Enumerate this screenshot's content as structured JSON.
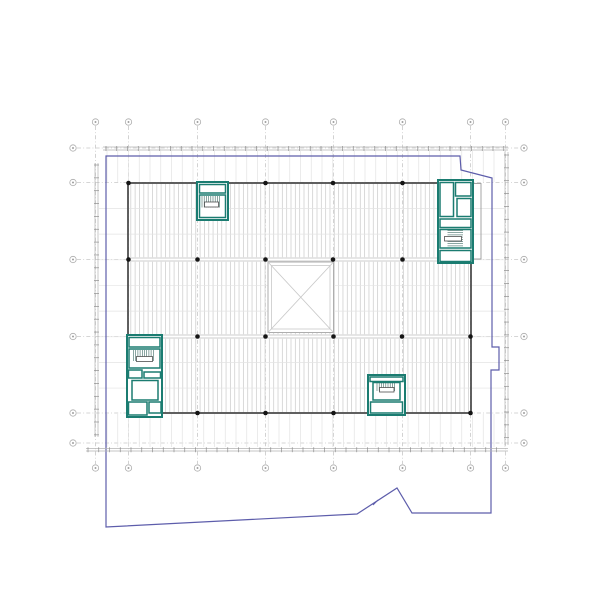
{
  "meta": {
    "canvas": {
      "w": 600,
      "h": 600,
      "bg": "#ffffff"
    },
    "drawing_kind": "architectural-floor-plan"
  },
  "palette": {
    "grid": "#c8c8c8",
    "hatch": "#d0d0d0",
    "faint": "#e3e3e3",
    "beam": "#bdbdbd",
    "dim": "#b3b3b3",
    "tick": "#8f8f8f",
    "outline": "#4f4f4f",
    "wallLight": "#9b9b9b",
    "teal": "#1b7c71",
    "tread": "#3d6a63",
    "blue": "#5d5dab",
    "black": "#151515",
    "shaft": "#aeaeae",
    "shaftX": "#c9c9c9",
    "bubble": "#adadad",
    "white": "#ffffff",
    "none": "none"
  },
  "grid": {
    "cols": [
      95.5,
      128.5,
      197.5,
      265.5,
      333.5,
      402.5,
      470.5,
      505.5
    ],
    "rows": [
      148,
      182.5,
      259.5,
      336.5,
      413,
      443
    ]
  },
  "layers": [
    {
      "t": "gridv",
      "n": "grid-line-vertical",
      "xs": [
        95.5,
        128.5,
        197.5,
        265.5,
        333.5,
        402.5,
        470.5,
        505.5
      ],
      "y0": 126,
      "y1": 464,
      "c": "grid",
      "w": 0.8,
      "dash": "4 2.2 0.9 2.2"
    },
    {
      "t": "gridh",
      "n": "grid-line-horizontal",
      "ys": [
        148,
        182.5,
        259.5,
        336.5,
        413,
        443
      ],
      "x0": 77,
      "x1": 520,
      "c": "grid",
      "w": 0.8,
      "dash": "4 2.2 0.9 2.2"
    },
    {
      "t": "vlines",
      "n": "extension-line-top",
      "x0": 107,
      "x1": 505,
      "step": 10.75,
      "y0": 151,
      "y1": 182,
      "c": "faint",
      "w": 0.7
    },
    {
      "t": "vlines",
      "n": "extension-line-bottom",
      "x0": 107,
      "x1": 505,
      "step": 10.75,
      "y0": 414,
      "y1": 447,
      "c": "faint",
      "w": 0.7
    },
    {
      "t": "hlines",
      "n": "extension-line-left",
      "y0": 208.5,
      "y1": 389,
      "step": 25.65,
      "x0": 99,
      "x1": 127.5,
      "c": "faint",
      "w": 0.7
    },
    {
      "t": "hlines",
      "n": "extension-line-right",
      "y0": 208.5,
      "y1": 389,
      "step": 25.65,
      "x0": 471.5,
      "x1": 504,
      "c": "faint",
      "w": 0.7
    },
    {
      "t": "vlines",
      "n": "deck-hatch",
      "x0": 130.8,
      "x1": 469.2,
      "step": 4.33,
      "y0": 183.6,
      "y1": 412.4,
      "c": "hatch",
      "w": 0.8
    },
    {
      "t": "hlines",
      "n": "secondary-beam-line",
      "y0": 208.5,
      "y1": 389,
      "step": 25.65,
      "x0": 129,
      "x1": 470,
      "c": "faint",
      "w": 0.7
    },
    {
      "t": "rect",
      "n": "beam-band",
      "x": 129,
      "y": 257.2,
      "w": 341,
      "h": 4.6,
      "f": "white",
      "s": "none",
      "sw": 0
    },
    {
      "t": "lines",
      "n": "beam-line",
      "segs": [
        [
          128,
          258,
          471,
          258
        ],
        [
          128,
          261,
          471,
          261
        ]
      ],
      "c": "beam",
      "w": 0.8
    },
    {
      "t": "rect",
      "n": "beam-band",
      "x": 129,
      "y": 334.2,
      "w": 341,
      "h": 4.6,
      "f": "white",
      "s": "none",
      "sw": 0
    },
    {
      "t": "lines",
      "n": "beam-line",
      "segs": [
        [
          128,
          335,
          471,
          335
        ],
        [
          128,
          338,
          471,
          338
        ]
      ],
      "c": "beam",
      "w": 0.8
    },
    {
      "t": "rect",
      "n": "atrium-shaft",
      "x": 268,
      "y": 262,
      "w": 65.5,
      "h": 70.5,
      "f": "white",
      "s": "shaft",
      "sw": 1
    },
    {
      "t": "rect",
      "n": "atrium-shaft-inner",
      "x": 271.5,
      "y": 265.5,
      "w": 58.5,
      "h": 63.5,
      "f": "none",
      "s": "shaftX",
      "sw": 0.8
    },
    {
      "t": "lines",
      "n": "atrium-x-brace",
      "segs": [
        [
          268,
          262,
          333.5,
          332.5
        ],
        [
          333.5,
          262,
          268,
          332.5
        ]
      ],
      "c": "shaftX",
      "w": 0.9
    },
    {
      "t": "rect",
      "n": "building-outline",
      "x": 128,
      "y": 183,
      "w": 343,
      "h": 230,
      "f": "none",
      "s": "outline",
      "sw": 1.8
    },
    {
      "t": "rect",
      "n": "building-annex-outline",
      "x": 471,
      "y": 183.5,
      "w": 10,
      "h": 75.5,
      "f": "none",
      "s": "wallLight",
      "sw": 0.9
    },
    {
      "t": "rect",
      "n": "stair-core-top-left",
      "x": 197,
      "y": 182,
      "w": 31,
      "h": 38,
      "f": "white",
      "s": "teal",
      "sw": 2
    },
    {
      "t": "rect",
      "n": "core-room",
      "x": 199.5,
      "y": 184.5,
      "w": 26,
      "h": 8.5,
      "f": "none",
      "s": "teal",
      "sw": 1.5
    },
    {
      "t": "rect",
      "n": "core-room",
      "x": 199.5,
      "y": 195,
      "w": 26,
      "h": 22.5,
      "f": "none",
      "s": "teal",
      "sw": 1.5
    },
    {
      "t": "vlines",
      "n": "stair-treads",
      "x0": 202,
      "x1": 221,
      "step": 2.2,
      "y0": 196,
      "y1": 207.5,
      "c": "tread",
      "w": 0.6
    },
    {
      "t": "rect",
      "n": "stair-landing",
      "x": 204.5,
      "y": 202,
      "w": 14,
      "h": 5,
      "f": "white",
      "s": "outline",
      "sw": 0.8
    },
    {
      "t": "rect",
      "n": "stair-core-top-right",
      "x": 438,
      "y": 180,
      "w": 35,
      "h": 83,
      "f": "white",
      "s": "teal",
      "sw": 2
    },
    {
      "t": "rect",
      "n": "core-room",
      "x": 440,
      "y": 182.5,
      "w": 13.5,
      "h": 34,
      "f": "none",
      "s": "teal",
      "sw": 1.5
    },
    {
      "t": "rect",
      "n": "core-room",
      "x": 455.5,
      "y": 182.5,
      "w": 15.5,
      "h": 13.5,
      "f": "none",
      "s": "teal",
      "sw": 1.5
    },
    {
      "t": "rect",
      "n": "core-room",
      "x": 457,
      "y": 198.5,
      "w": 14,
      "h": 18,
      "f": "none",
      "s": "teal",
      "sw": 1.5
    },
    {
      "t": "rect",
      "n": "core-room",
      "x": 440,
      "y": 219,
      "w": 31,
      "h": 8.5,
      "f": "none",
      "s": "teal",
      "sw": 1.5
    },
    {
      "t": "rect",
      "n": "core-room",
      "x": 440,
      "y": 229.5,
      "w": 31,
      "h": 18.5,
      "f": "none",
      "s": "teal",
      "sw": 1.5
    },
    {
      "t": "rect",
      "n": "core-room",
      "x": 440,
      "y": 250.5,
      "w": 31,
      "h": 11,
      "f": "none",
      "s": "teal",
      "sw": 1.5
    },
    {
      "t": "hlines",
      "n": "stair-treads",
      "y0": 230.5,
      "y1": 247,
      "step": 2.2,
      "x0": 447.5,
      "x1": 463,
      "c": "tread",
      "w": 0.6
    },
    {
      "t": "rect",
      "n": "stair-landing",
      "x": 444.5,
      "y": 236.5,
      "w": 17,
      "h": 4.5,
      "f": "white",
      "s": "outline",
      "sw": 0.8
    },
    {
      "t": "rect",
      "n": "stair-core-bottom-left",
      "x": 127,
      "y": 335,
      "w": 35,
      "h": 82,
      "f": "white",
      "s": "teal",
      "sw": 2
    },
    {
      "t": "rect",
      "n": "core-room",
      "x": 129,
      "y": 337.5,
      "w": 31,
      "h": 9.5,
      "f": "none",
      "s": "teal",
      "sw": 1.5
    },
    {
      "t": "rect",
      "n": "core-room",
      "x": 129,
      "y": 349,
      "w": 31,
      "h": 19,
      "f": "none",
      "s": "teal",
      "sw": 1.5
    },
    {
      "t": "rect",
      "n": "core-room",
      "x": 128.5,
      "y": 370,
      "w": 13.5,
      "h": 8,
      "f": "none",
      "s": "teal",
      "sw": 1.5
    },
    {
      "t": "rect",
      "n": "core-room",
      "x": 144,
      "y": 372,
      "w": 16.5,
      "h": 6,
      "f": "none",
      "s": "teal",
      "sw": 1.5
    },
    {
      "t": "rect",
      "n": "core-room",
      "x": 132,
      "y": 380.5,
      "w": 26,
      "h": 19.5,
      "f": "none",
      "s": "teal",
      "sw": 1.5
    },
    {
      "t": "rect",
      "n": "core-room",
      "x": 128.5,
      "y": 402,
      "w": 18.5,
      "h": 13,
      "f": "none",
      "s": "teal",
      "sw": 1.5
    },
    {
      "t": "rect",
      "n": "core-room",
      "x": 149,
      "y": 402,
      "w": 12,
      "h": 11,
      "f": "none",
      "s": "teal",
      "sw": 1.5
    },
    {
      "t": "vlines",
      "n": "stair-treads",
      "x0": 133.5,
      "x1": 155,
      "step": 2.2,
      "y0": 350,
      "y1": 361,
      "c": "tread",
      "w": 0.6
    },
    {
      "t": "rect",
      "n": "stair-landing",
      "x": 136.5,
      "y": 356.5,
      "w": 16,
      "h": 5,
      "f": "white",
      "s": "outline",
      "sw": 0.8
    },
    {
      "t": "rect",
      "n": "stair-core-bottom-right",
      "x": 368,
      "y": 375,
      "w": 37,
      "h": 40,
      "f": "white",
      "s": "teal",
      "sw": 2
    },
    {
      "t": "rect",
      "n": "core-room",
      "x": 370,
      "y": 377,
      "w": 33,
      "h": 4.5,
      "f": "none",
      "s": "teal",
      "sw": 1.5
    },
    {
      "t": "rect",
      "n": "core-room",
      "x": 373,
      "y": 382.5,
      "w": 27,
      "h": 17.5,
      "f": "none",
      "s": "teal",
      "sw": 1.5
    },
    {
      "t": "rect",
      "n": "core-room",
      "x": 370.5,
      "y": 402,
      "w": 32,
      "h": 11,
      "f": "none",
      "s": "teal",
      "sw": 1.5
    },
    {
      "t": "vlines",
      "n": "stair-treads",
      "x0": 377,
      "x1": 396,
      "step": 2.2,
      "y0": 383,
      "y1": 391,
      "c": "tread",
      "w": 0.6
    },
    {
      "t": "rect",
      "n": "stair-landing",
      "x": 379.5,
      "y": 387.5,
      "w": 14.5,
      "h": 4.5,
      "f": "white",
      "s": "outline",
      "sw": 0.8
    },
    {
      "t": "dots",
      "n": "column-dot",
      "r": 2.3,
      "c": "black",
      "pts": [
        [
          128.5,
          183
        ],
        [
          265.5,
          183
        ],
        [
          333,
          183
        ],
        [
          402.5,
          183
        ],
        [
          128.5,
          259.5
        ],
        [
          197.5,
          259.5
        ],
        [
          265.5,
          259.5
        ],
        [
          333,
          259.5
        ],
        [
          402.5,
          259.5
        ],
        [
          197.5,
          336.5
        ],
        [
          265.5,
          336.5
        ],
        [
          333.5,
          336.5
        ],
        [
          402,
          336.5
        ],
        [
          470.5,
          336.5
        ],
        [
          197.5,
          413
        ],
        [
          265.5,
          413
        ],
        [
          333.5,
          413
        ],
        [
          470.5,
          413
        ]
      ]
    },
    {
      "t": "poly",
      "n": "property-boundary",
      "close": true,
      "f": "none",
      "s": "blue",
      "w": 1.2,
      "pts": [
        [
          106,
          156
        ],
        [
          460,
          156
        ],
        [
          461,
          170
        ],
        [
          492,
          178
        ],
        [
          492,
          347
        ],
        [
          499,
          347
        ],
        [
          499,
          370
        ],
        [
          491,
          370
        ],
        [
          491,
          513
        ],
        [
          412,
          513
        ],
        [
          397,
          488
        ],
        [
          357,
          514
        ],
        [
          106,
          527
        ]
      ]
    },
    {
      "t": "lines",
      "n": "boundary-arrow-tick",
      "segs": [
        [
          373,
          505,
          378,
          500
        ]
      ],
      "c": "blue",
      "w": 1
    },
    {
      "t": "lines",
      "n": "dimension-line-top",
      "segs": [
        [
          103,
          147,
          508,
          147
        ],
        [
          103,
          150,
          508,
          150
        ]
      ],
      "c": "dim",
      "w": 0.7
    },
    {
      "t": "lines",
      "n": "dimension-line-bottom",
      "segs": [
        [
          86,
          448.5,
          508,
          448.5
        ],
        [
          86,
          451,
          508,
          451
        ]
      ],
      "c": "dim",
      "w": 0.7
    },
    {
      "t": "lines",
      "n": "dimension-line-left",
      "segs": [
        [
          95,
          163,
          95,
          437
        ],
        [
          98,
          163,
          98,
          437
        ]
      ],
      "c": "dim",
      "w": 0.7
    },
    {
      "t": "lines",
      "n": "dimension-line-right",
      "segs": [
        [
          505,
          152,
          505,
          445
        ],
        [
          508,
          152,
          508,
          445
        ]
      ],
      "c": "dim",
      "w": 0.7
    },
    {
      "t": "ticksx",
      "n": "dimension-tick",
      "x0": 106,
      "x1": 506,
      "step": 10.75,
      "y": 148.5,
      "len": 5,
      "c": "tick",
      "w": 0.7
    },
    {
      "t": "ticksx",
      "n": "dimension-tick",
      "x0": 88,
      "x1": 506,
      "step": 10.75,
      "y": 449.7,
      "len": 5,
      "c": "tick",
      "w": 0.7
    },
    {
      "t": "ticksy",
      "n": "dimension-tick",
      "y0": 165,
      "y1": 436,
      "step": 12.85,
      "x": 96.5,
      "len": 5,
      "c": "tick",
      "w": 0.7
    },
    {
      "t": "ticksy",
      "n": "dimension-tick",
      "y0": 155,
      "y1": 442,
      "step": 12.85,
      "x": 506.5,
      "len": 5,
      "c": "tick",
      "w": 0.7
    },
    {
      "t": "bubblesx",
      "n": "grid-bubble-top",
      "xs": [
        95.5,
        128.5,
        197.5,
        265.5,
        333.5,
        402.5,
        470.5,
        505.5
      ],
      "cy": 122,
      "r": 3.2,
      "s": "bubble",
      "w": 0.8
    },
    {
      "t": "bubblesx",
      "n": "grid-bubble-bottom",
      "xs": [
        95.5,
        128.5,
        197.5,
        265.5,
        333.5,
        402.5,
        470.5,
        505.5
      ],
      "cy": 468,
      "r": 3.2,
      "s": "bubble",
      "w": 0.8
    },
    {
      "t": "bubblesy",
      "n": "grid-bubble-left",
      "ys": [
        148,
        182.5,
        259.5,
        336.5,
        413,
        443
      ],
      "cx": 73,
      "r": 3.2,
      "s": "bubble",
      "w": 0.8
    },
    {
      "t": "bubblesy",
      "n": "grid-bubble-right",
      "ys": [
        148,
        182.5,
        259.5,
        336.5,
        413,
        443
      ],
      "cx": 524,
      "r": 3.2,
      "s": "bubble",
      "w": 0.8
    }
  ]
}
